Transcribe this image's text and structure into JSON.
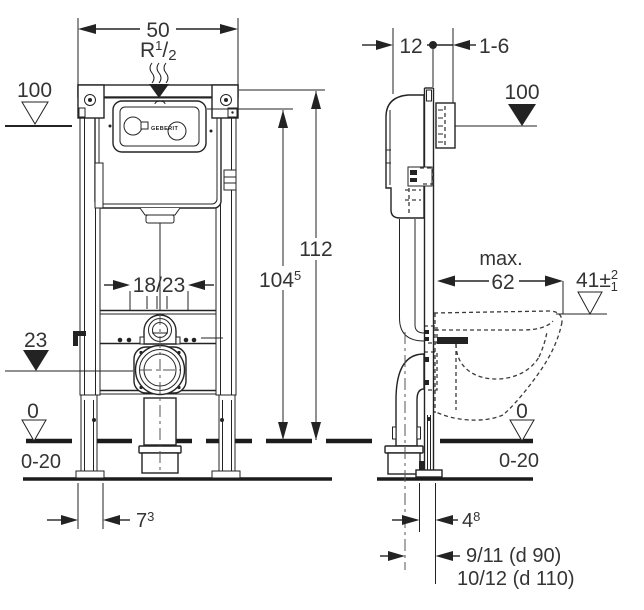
{
  "front": {
    "width": "50",
    "supply_base": "R",
    "supply_sup": "1",
    "supply_slash": "/",
    "supply_sub": "2",
    "datum_top": "100",
    "height_total": "112",
    "height_actuator_main": "104",
    "height_actuator_sup": "5",
    "flush_range": "18/23",
    "datum_outlet": "23",
    "datum_floor": "0",
    "floor_range": "0-20",
    "foot_offset_main": "7",
    "foot_offset_sup": "3",
    "logo": "GEBERIT"
  },
  "side": {
    "depth": "12",
    "wall_range": "1-6",
    "datum_top": "100",
    "max_label": "max.",
    "bowl_depth": "62",
    "seat_height_main": "41",
    "seat_height_pm": "±",
    "seat_height_sup": "2",
    "seat_height_sub": "1",
    "datum_floor": "0",
    "floor_range": "0-20",
    "outlet_offset_main": "4",
    "outlet_offset_sup": "8",
    "outlet_line1": "9/11 (d 90)",
    "outlet_line2": "10/12 (d 110)"
  },
  "colors": {
    "line": "#232323",
    "text": "#343434",
    "background": "#ffffff"
  }
}
